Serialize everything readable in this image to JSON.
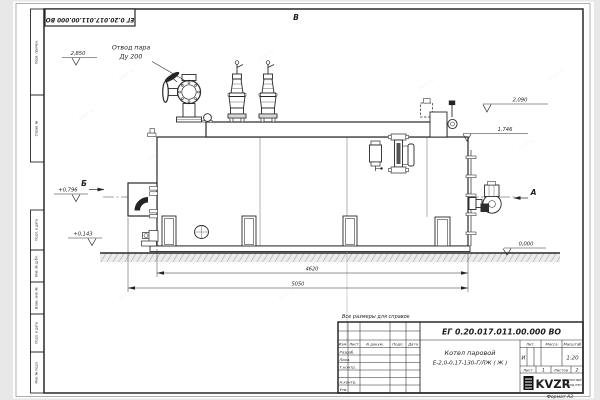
{
  "watermark": "kvzr.ru",
  "frame": {
    "doc_number_flipped": "ЕГ 0.20.017.011.00.000  ВО",
    "format_label": "Формат А3",
    "side_stamps": [
      "Перв. примен.",
      "Справ. №",
      "Подп. и дата",
      "Инв. № дубл.",
      "Взам. инв. №",
      "Подп. и дата",
      "Инв. № подл."
    ]
  },
  "views": {
    "top": "В",
    "left": "Б",
    "right": "А"
  },
  "callouts": {
    "steam_outlet_1": "Отвод пара",
    "steam_outlet_2": "Ду 200"
  },
  "elevations": {
    "valve_top": "2,850",
    "fitting_top": "2,090",
    "drum_top": "1,746",
    "burner_axis": "+0,796",
    "frame_top": "+0,143",
    "ground": "0,000"
  },
  "dimensions": {
    "support_span": "4620",
    "overall_length": "5050"
  },
  "title_block": {
    "note": "Все размеры для справок",
    "doc_number": "ЕГ 0.20.017.011.00.000  ВО",
    "product_name_1": "Котел паровой",
    "product_name_2": "Е-2,0-0,17-130-Г/ЛЖ ( Ж )",
    "col_izm": "Изм.",
    "col_list": "Лист",
    "col_ndokum": "N докум.",
    "col_podp": "Подп.",
    "col_data": "Дата",
    "row_razrab": "Разраб.",
    "row_prov": "Пров.",
    "row_tkontr": "Т.контр.",
    "row_nkontr": "Н.контр.",
    "row_utv": "Утв.",
    "lit_label": "Лит.",
    "mass_label": "Масса",
    "scale_label": "Масштаб",
    "lit_value": "И",
    "scale_value": "1:20",
    "sheet_label": "Лист",
    "sheet_value": "1",
    "sheets_label": "Листов",
    "sheets_value": "2",
    "logo": "KVZR",
    "logo_sub_1": "КОТЕЛЬНЫЙ",
    "logo_sub_2": "ЗАВОД РЭП"
  }
}
